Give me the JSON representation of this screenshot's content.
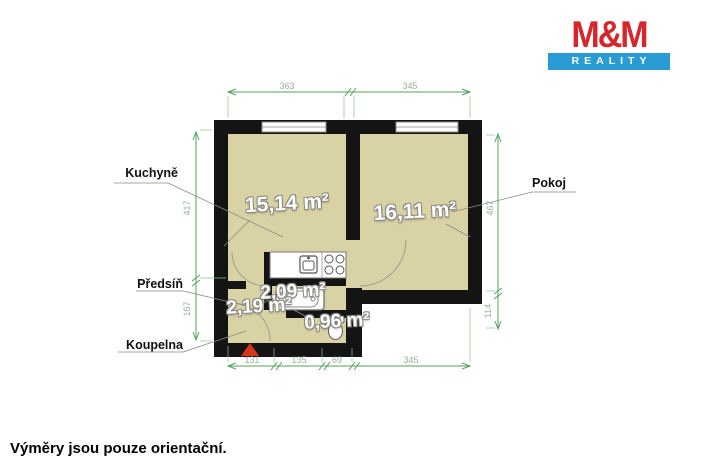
{
  "logo": {
    "line1": "M&M",
    "line2": "REALITY"
  },
  "footer": {
    "disclaimer": "Výměry jsou pouze orientační."
  },
  "rooms": {
    "kuchyne": {
      "label": "Kuchyně",
      "area": "15,14 m²"
    },
    "pokoj": {
      "label": "Pokoj",
      "area": "16,11 m²"
    },
    "predsin": {
      "label": "Předsíň",
      "area": "2,09 m²"
    },
    "koupelna": {
      "label": "Koupelna",
      "area": "2,19 m²"
    },
    "wc": {
      "area": "0,96 m²"
    }
  },
  "dimensions": {
    "top": {
      "d1": "363",
      "d2": "345"
    },
    "bottom": {
      "d1": "131",
      "d2": "135",
      "d3": "69",
      "d4": "345"
    },
    "left": {
      "d1": "417",
      "d2": "167"
    },
    "right": {
      "d1": "467",
      "d2": "114"
    }
  },
  "colors": {
    "floor": "#d8d2a4",
    "wall": "#141414",
    "dimension_line": "#55a35a",
    "dimension_text": "#96b496",
    "logo_red": "#d6252b",
    "logo_blue": "#2a9cd5",
    "entrance_marker": "#d43417"
  }
}
